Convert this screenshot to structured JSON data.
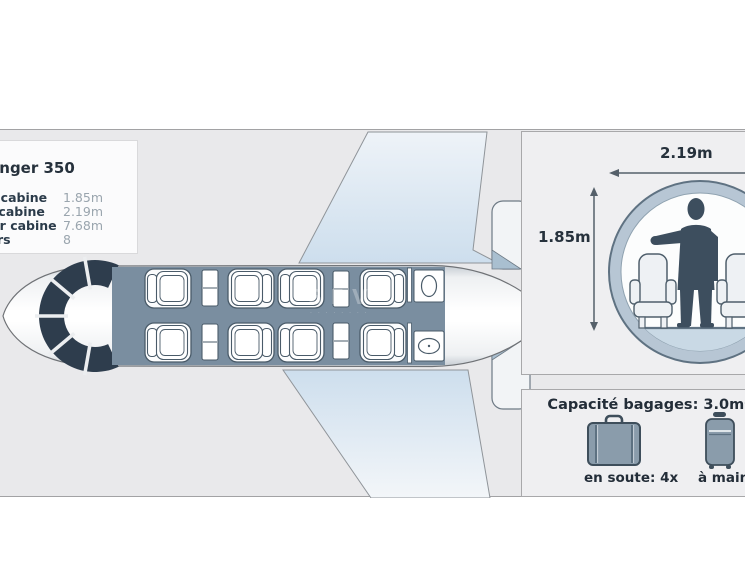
{
  "info_panel": {
    "title": "Challenger 350",
    "specs": [
      {
        "label": "Hauteur cabine",
        "value": "1.85m"
      },
      {
        "label": "Largeur cabine",
        "value": "2.19m"
      },
      {
        "label": "Longueur cabine",
        "value": "7.68m"
      },
      {
        "label": "Passagers",
        "value": "8"
      }
    ]
  },
  "cross_section": {
    "width_label": "2.19m",
    "height_label": "1.85m"
  },
  "baggage": {
    "title": "Capacité bagages: 3.0m³",
    "hold_label": "en soute: 4x",
    "hand_label": "à main: 4x"
  },
  "watermark": {
    "text": "SEV",
    "tagline": "· · · · · · · ·"
  },
  "colors": {
    "stage_bg": "#e9e9eb",
    "panel_bg": "#efeff1",
    "cabin_slate": "#7a8ea0",
    "cockpit_dark": "#2e3d4d",
    "silhouette": "#3d4e5e",
    "ring_blue": "#b7c6d4",
    "floor_blue": "#c9d9e5",
    "wing_blue": "#cddeed",
    "luggage_fill": "#8a9cab",
    "text_dark": "#26313c",
    "text_gray": "#9aa5ae"
  }
}
